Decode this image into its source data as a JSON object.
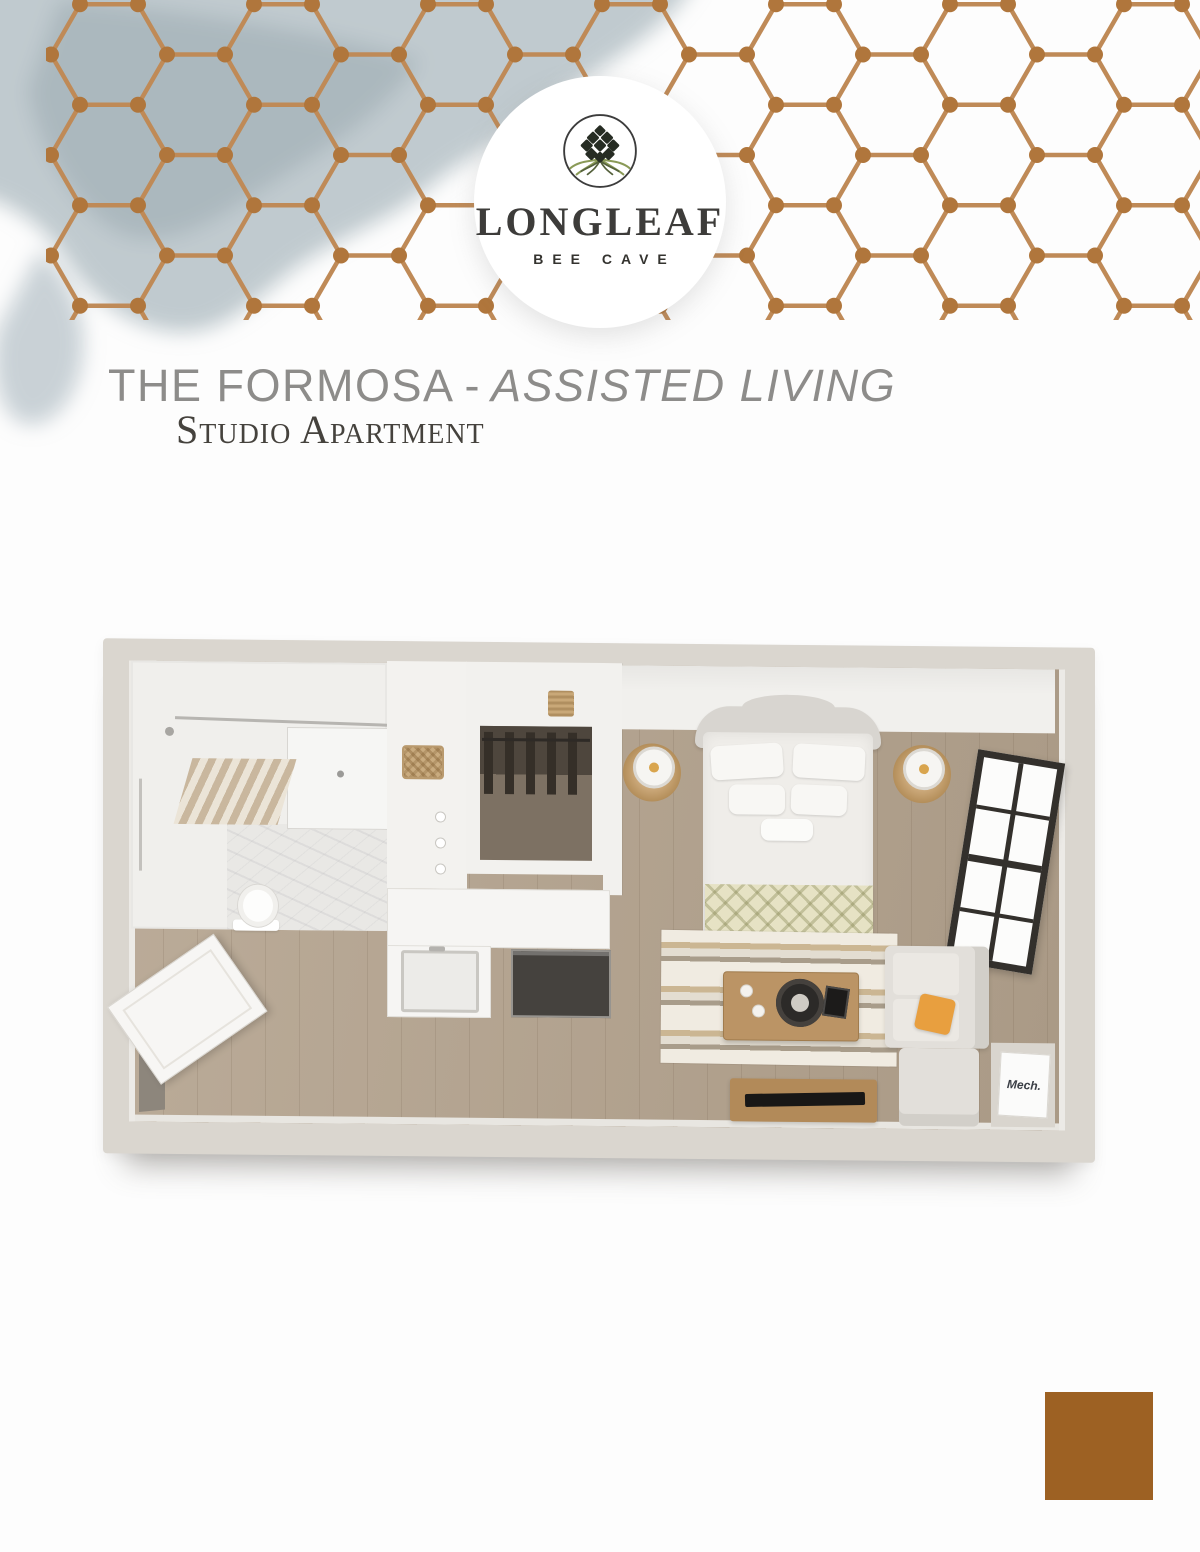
{
  "brand": {
    "logo_title": "LONGLEAF",
    "logo_subtitle": "BEE CAVE"
  },
  "heading": {
    "title": "THE FORMOSA",
    "dash": "-",
    "qualifier": "ASSISTED LIVING",
    "subtitle": "Studio Apartment"
  },
  "floorplan": {
    "mech_label": "Mech."
  },
  "colors": {
    "copper_line": "#bf8a57",
    "copper_dot": "#b0763c",
    "brand_square": "#9d6123",
    "watercolor": "#a8b5bd",
    "wall": "#dad6cf",
    "wood_floor": "#b3a28d",
    "pillow_orange": "#e89f3f"
  }
}
